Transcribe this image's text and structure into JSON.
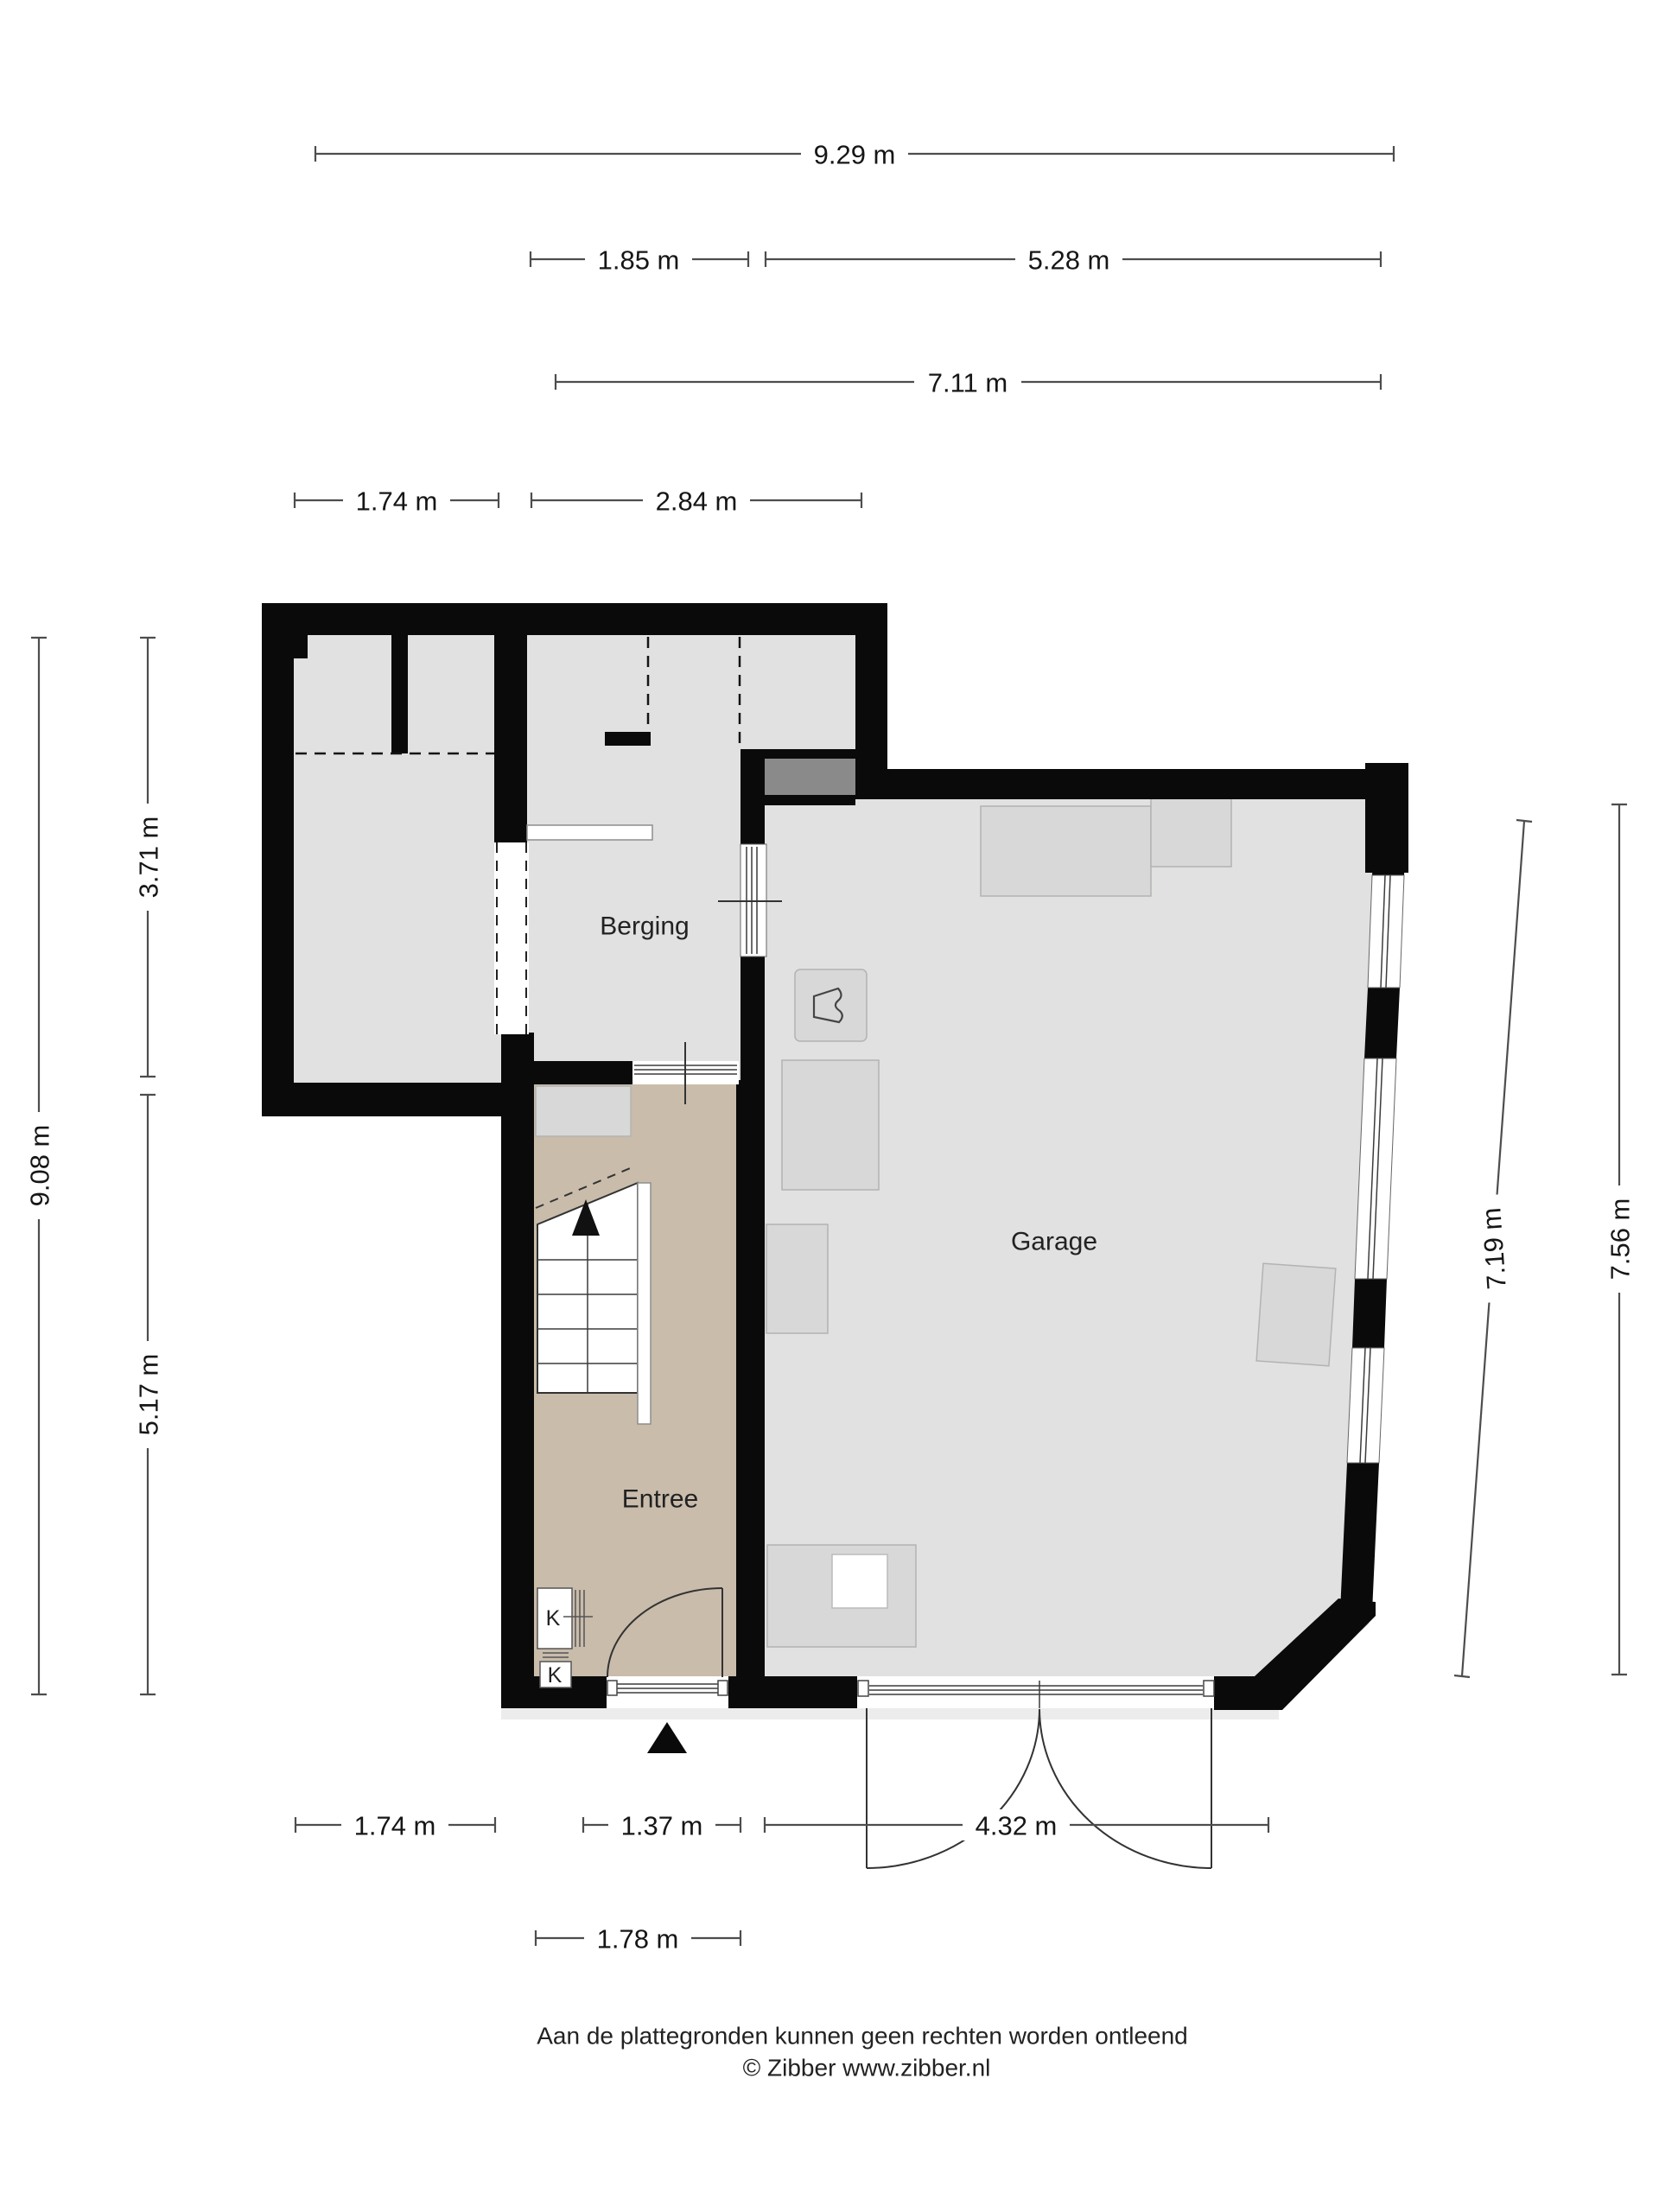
{
  "labels": {
    "berging": "Berging",
    "garage": "Garage",
    "entree": "Entree",
    "closet_top": "K",
    "closet_bottom": "K"
  },
  "dims": {
    "top_total": "9.29 m",
    "top_berging": "1.85 m",
    "top_garage": "5.28 m",
    "top_inner": "7.11 m",
    "top_room": "1.74 m",
    "top_hall": "2.84 m",
    "left_top": "3.71 m",
    "left_total": "9.08 m",
    "left_bottom": "5.17 m",
    "right_inner": "7.19 m",
    "right_total": "7.56 m",
    "bottom_room": "1.74 m",
    "bottom_entree": "1.37 m",
    "bottom_garage": "4.32 m",
    "bottom_door": "1.78 m"
  },
  "footer": {
    "disclaimer": "Aan de plattegronden kunnen geen rechten worden ontleend",
    "copyright": "© Zibber www.zibber.nl"
  },
  "colors": {
    "wall": "#0a0a0a",
    "floor": "#e0e1e0",
    "entree_floor": "#c9bcab",
    "furniture": "#d7d8d7",
    "dark_recess": "#8a8a8a",
    "dim_line": "#4d4d4d",
    "text": "#161616"
  }
}
